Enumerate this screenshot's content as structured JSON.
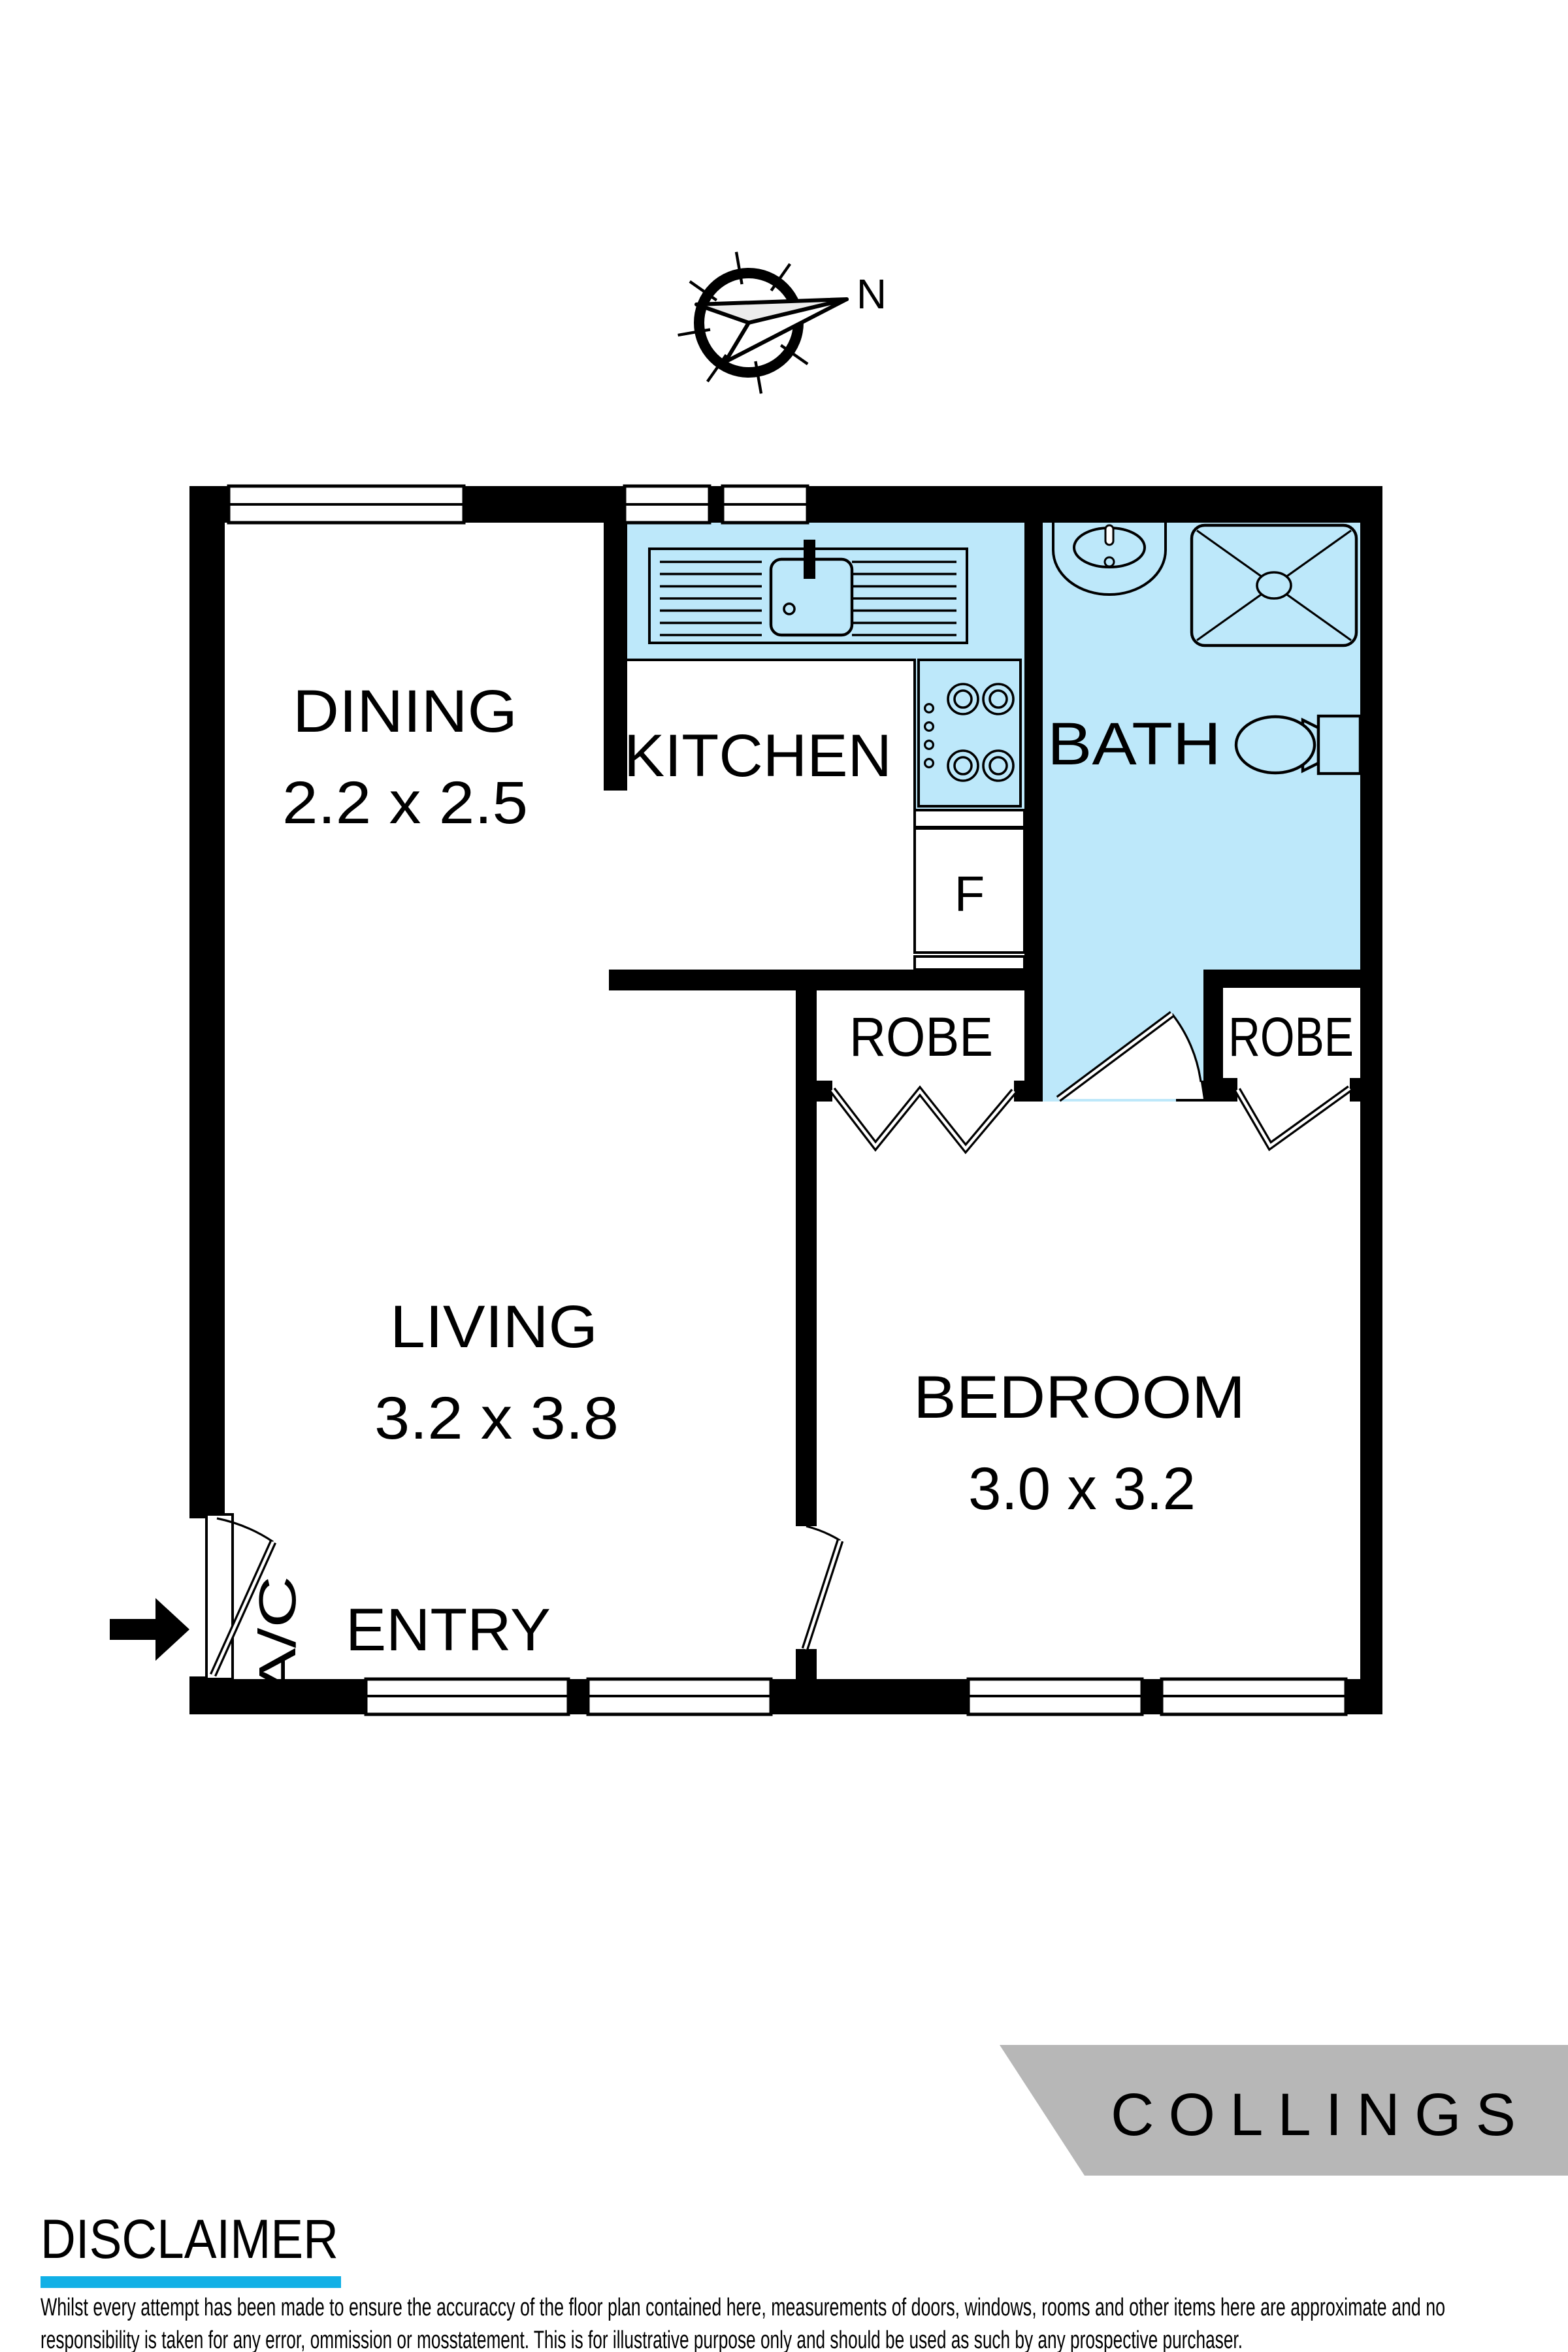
{
  "compass": {
    "label": "N"
  },
  "plan": {
    "rooms": {
      "dining": {
        "name": "DINING",
        "dims": "2.2 x 2.5"
      },
      "kitchen": {
        "name": "KITCHEN"
      },
      "bath": {
        "name": "BATH"
      },
      "robe_left": {
        "name": "ROBE"
      },
      "robe_right": {
        "name": "ROBE"
      },
      "living": {
        "name": "LIVING",
        "dims": "3.2 x 3.8"
      },
      "bedroom": {
        "name": "BEDROOM",
        "dims": "3.0 x 3.2"
      },
      "entry": {
        "name": "ENTRY"
      }
    },
    "labels": {
      "fridge": "F",
      "air_conditioner": "A/C"
    }
  },
  "branding": {
    "logo": "COLLINGS",
    "logo_bg": "#b7b7b7",
    "logo_text_color": "#ffffff"
  },
  "disclaimer": {
    "heading": "DISCLAIMER",
    "heading_color": "#1f3040",
    "underline_color": "#11b0e6",
    "line1": "Whilst every attempt has been made to ensure the accuraccy of the floor plan contained here, measurements of doors, windows, rooms and other items here are approximate and no",
    "line2": "responsibility is taken for any error, ommission or mosstatement. This is for illustrative purpose only and should be used as such by any prospective purchaser."
  },
  "colors": {
    "fixture_fill": "#bde8fa",
    "wall": "#000000"
  }
}
